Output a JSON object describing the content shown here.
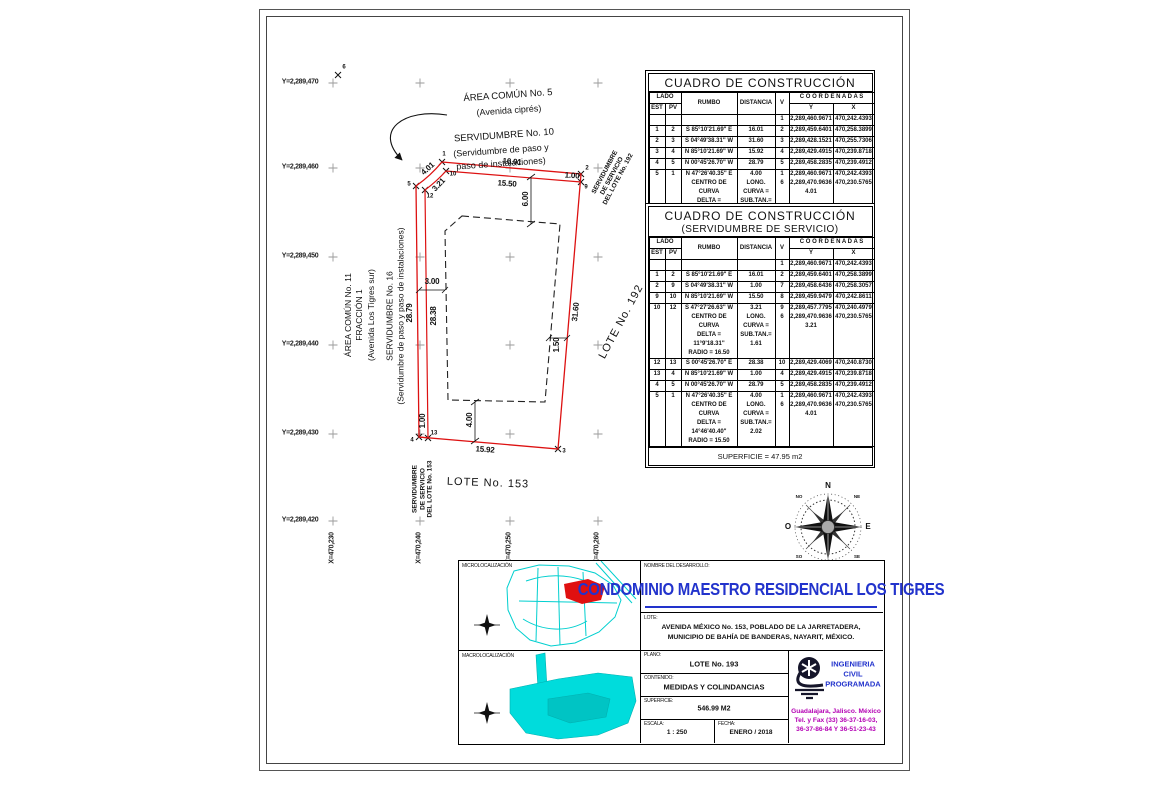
{
  "colors": {
    "boundary_red": "#dd1111",
    "map_cyan": "#00d0d0",
    "title_blue": "#2233cc",
    "contact_purple": "#b400b4"
  },
  "drawing": {
    "grid_y": [
      "Y=2,289,470",
      "Y=2,289,460",
      "Y=2,289,450",
      "Y=2,289,440",
      "Y=2,289,430",
      "Y=2,289,420"
    ],
    "grid_x": [
      "X=470,230",
      "X=470,240",
      "X=470,250",
      "X=470,260"
    ],
    "vertices": {
      "p1": "1",
      "p2": "2",
      "p3": "3",
      "p4": "4",
      "p5": "5",
      "p6": "6",
      "p9": "9",
      "p10": "10",
      "p12": "12",
      "p13": "13"
    },
    "dims": {
      "top_outer": "16.01",
      "top_inner": "15.50",
      "right_cap": "1.00",
      "arc_outer": "4.01",
      "arc_inner": "3.21",
      "setback_top": "6.00",
      "right_edge": "31.60",
      "setback_right": "1.50",
      "left_outer": "28.79",
      "left_inner": "28.38",
      "setback_left": "3.00",
      "bottom_cap": "1.00",
      "bottom_edge": "15.92",
      "setback_bottom": "4.00"
    },
    "annotations": {
      "area5_line1": "ÁREA COMÚN No. 5",
      "area5_line2": "(Avenida ciprés)",
      "serv10_line1": "SERVIDUMBRE No. 10",
      "serv10_line2": "(Servidumbre de paso y",
      "serv10_line3": "paso de instalaciones)",
      "area11": "ÁREA COMÚN No. 11\nFRACCIÓN 1\n(Avenida Los Tigres sur)",
      "serv16": "SERVIDUMBRE No. 16\n(Servidumbre de paso y paso de instalaciones)",
      "lote192": "LOTE No. 192",
      "serv192": "SERVIDUMBRE\nDE SERVICIO\nDEL LOTE No. 192",
      "lote153": "LOTE No. 153",
      "serv153": "SERVIDUMBRE\nDE SERVICIO\nDEL LOTE No. 153"
    }
  },
  "compass": {
    "n": "N",
    "s": "S",
    "e": "E",
    "o": "O",
    "ne": "NE",
    "no": "NO",
    "se": "SE",
    "so": "SO"
  },
  "tables": {
    "headers": {
      "lado": "LADO",
      "est": "EST",
      "pv": "PV",
      "rumbo": "RUMBO",
      "distancia": "DISTANCIA",
      "v": "V",
      "coordenadas": "C O O R D E N A D A S",
      "y": "Y",
      "x": "X"
    },
    "t1": {
      "title": "CUADRO DE CONSTRUCCIÓN",
      "rows": [
        {
          "est": "",
          "pv": "",
          "rumbo": "",
          "dist": "",
          "v": "1",
          "y": "2,289,460.9671",
          "x": "470,242.4393"
        },
        {
          "est": "1",
          "pv": "2",
          "rumbo": "S 85°10'21.69\" E",
          "dist": "16.01",
          "v": "2",
          "y": "2,289,459.6401",
          "x": "470,258.3899"
        },
        {
          "est": "2",
          "pv": "3",
          "rumbo": "S 04°49'38.31\" W",
          "dist": "31.60",
          "v": "3",
          "y": "2,289,428.1521",
          "x": "470,255.7306"
        },
        {
          "est": "3",
          "pv": "4",
          "rumbo": "N 85°10'21.69\" W",
          "dist": "15.92",
          "v": "4",
          "y": "2,289,429.4915",
          "x": "470,239.8718"
        },
        {
          "est": "4",
          "pv": "5",
          "rumbo": "N 00°45'26.70\" W",
          "dist": "28.79",
          "v": "5",
          "y": "2,289,458.2835",
          "x": "470,239.4912"
        },
        {
          "est": "5",
          "pv": "1",
          "rumbo": "N 47°26'40.35\" E\nCENTRO DE CURVA\nDELTA = 14°46'40.40\"\nRADIO = 15.50",
          "dist": "4.00\nLONG. CURVA =\nSUB.TAN.= 2.02",
          "v": "1\n6",
          "y": "2,289,460.9671\n2,289,470.9636\n4.01",
          "x": "470,242.4393\n470,230.5765"
        }
      ]
    },
    "t2": {
      "title": "CUADRO DE CONSTRUCCIÓN",
      "subtitle": "(SERVIDUMBRE DE SERVICIO)",
      "footer": "SUPERFICIE = 47.95 m2",
      "rows": [
        {
          "est": "",
          "pv": "",
          "rumbo": "",
          "dist": "",
          "v": "1",
          "y": "2,289,460.9671",
          "x": "470,242.4393"
        },
        {
          "est": "1",
          "pv": "2",
          "rumbo": "S 85°10'21.69\" E",
          "dist": "16.01",
          "v": "2",
          "y": "2,289,459.6401",
          "x": "470,258.3899"
        },
        {
          "est": "2",
          "pv": "9",
          "rumbo": "S 04°49'38.31\" W",
          "dist": "1.00",
          "v": "7",
          "y": "2,289,458.6436",
          "x": "470,258.3057"
        },
        {
          "est": "9",
          "pv": "10",
          "rumbo": "N 85°10'21.69\" W",
          "dist": "15.50",
          "v": "8",
          "y": "2,289,459.9479",
          "x": "470,242.8611"
        },
        {
          "est": "10",
          "pv": "12",
          "rumbo": "S 47°27'26.63\" W\nCENTRO DE CURVA\nDELTA = 11°9'18.31\"\nRADIO = 16.50",
          "dist": "3.21\nLONG. CURVA =\nSUB.TAN.= 1.61",
          "v": "9\n6",
          "y": "2,289,457.7795\n2,289,470.9636\n3.21",
          "x": "470,240.4979\n470,230.5765"
        },
        {
          "est": "12",
          "pv": "13",
          "rumbo": "S 00°45'26.70\" E",
          "dist": "28.38",
          "v": "10",
          "y": "2,289,429.4069",
          "x": "470,240.8730"
        },
        {
          "est": "13",
          "pv": "4",
          "rumbo": "N 85°10'21.69\" W",
          "dist": "1.00",
          "v": "4",
          "y": "2,289,429.4915",
          "x": "470,239.8718"
        },
        {
          "est": "4",
          "pv": "5",
          "rumbo": "N 00°45'26.70\" W",
          "dist": "28.79",
          "v": "5",
          "y": "2,289,458.2835",
          "x": "470,239.4912"
        },
        {
          "est": "5",
          "pv": "1",
          "rumbo": "N 47°26'40.35\" E\nCENTRO DE CURVA\nDELTA = 14°46'40.40\"\nRADIO = 15.50",
          "dist": "4.00\nLONG. CURVA =\nSUB.TAN.= 2.02",
          "v": "1\n6",
          "y": "2,289,460.9671\n2,289,470.9636\n4.01",
          "x": "470,242.4393\n470,230.5765"
        }
      ]
    }
  },
  "titleblock": {
    "micro_label": "MICROLOCALIZACIÓN",
    "macro_label": "MACROLOCALIZACIÓN",
    "nombre_label": "NOMBRE DEL DESARROLLO:",
    "nombre_value": "CONDOMINIO MAESTRO RESIDENCIAL LOS TIGRES",
    "lote_label": "LOTE:",
    "lote_value": "AVENIDA MÉXICO No. 153, POBLADO DE LA JARRETADERA,\nMUNICIPIO DE BAHÍA DE BANDERAS, NAYARIT, MÉXICO.",
    "plano_label": "PLANO:",
    "plano_value": "LOTE No. 193",
    "contenido_label": "CONTENIDO:",
    "contenido_value": "MEDIDAS Y COLINDANCIAS",
    "superficie_label": "SUPERFICIE:",
    "superficie_value": "546.99 M2",
    "escala_label": "ESCALA:",
    "escala_value": "1 : 250",
    "fecha_label": "FECHA:",
    "fecha_value": "ENERO / 2018",
    "firm_name": "INGENIERIA\nCIVIL\nPROGRAMADA",
    "firm_contact": "Guadalajara, Jalisco. México\nTel. y Fax (33) 36-37-16-03,\n36-37-86-84 Y 36-51-23-43"
  }
}
